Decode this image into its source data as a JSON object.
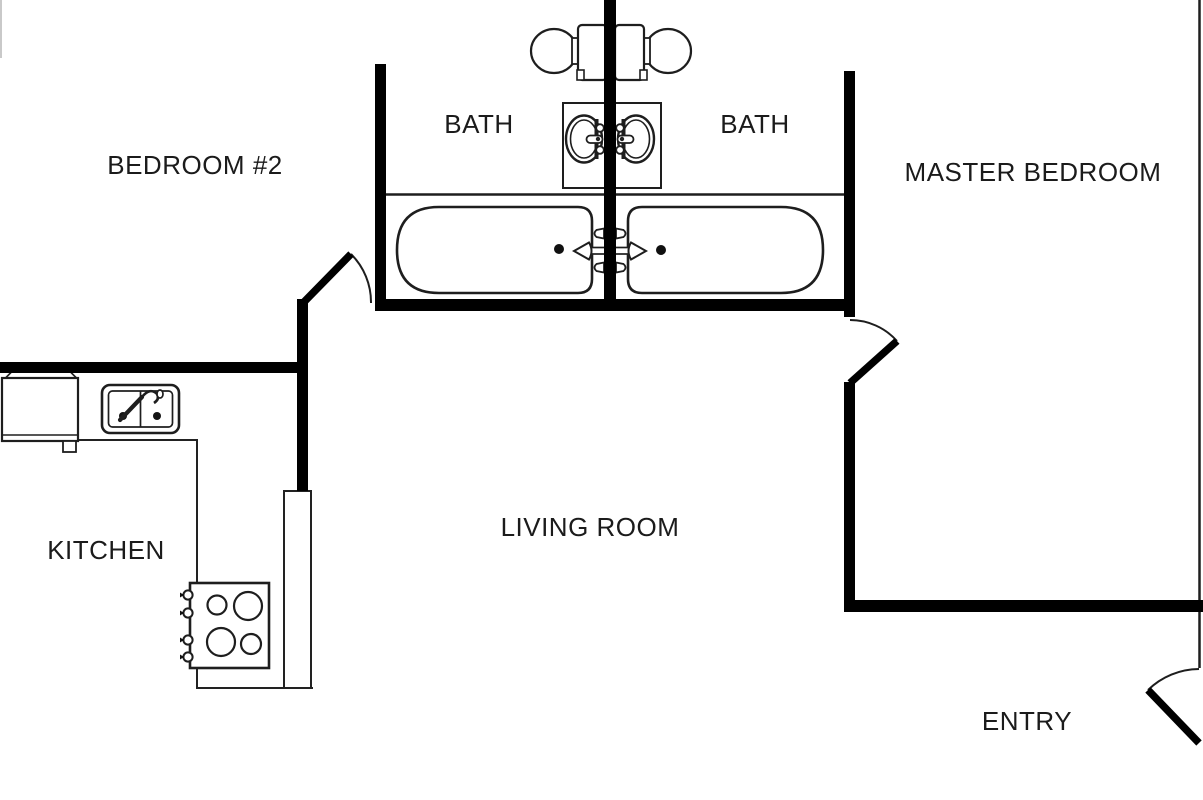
{
  "page": {
    "title": "Apartment Floor Plan",
    "background": "#ffffff",
    "wall_color": "#000000",
    "fixture_line_color": "#1e1e1e",
    "text_color": "#1b1b1b"
  },
  "rooms": [
    {
      "name": "bedroom-2",
      "label": "BEDROOM #2"
    },
    {
      "name": "bath-left",
      "label": "BATH"
    },
    {
      "name": "bath-right",
      "label": "BATH"
    },
    {
      "name": "master-bedroom",
      "label": "MASTER BEDROOM"
    },
    {
      "name": "kitchen",
      "label": "KITCHEN"
    },
    {
      "name": "living-room",
      "label": "LIVING ROOM"
    },
    {
      "name": "entry",
      "label": "ENTRY"
    }
  ],
  "fixtures": [
    {
      "name": "toilet-left",
      "room": "bath-left"
    },
    {
      "name": "toilet-right",
      "room": "bath-right"
    },
    {
      "name": "vanity-sink-left",
      "room": "bath-left"
    },
    {
      "name": "vanity-sink-right",
      "room": "bath-right"
    },
    {
      "name": "bathtub-left",
      "room": "bath-left"
    },
    {
      "name": "bathtub-right",
      "room": "bath-right"
    },
    {
      "name": "refrigerator",
      "room": "kitchen"
    },
    {
      "name": "kitchen-sink",
      "room": "kitchen"
    },
    {
      "name": "cooktop",
      "room": "kitchen"
    },
    {
      "name": "door-swing",
      "room": "bedroom-2"
    },
    {
      "name": "door-swing",
      "room": "master-bedroom"
    },
    {
      "name": "door-swing",
      "room": "entry"
    }
  ]
}
